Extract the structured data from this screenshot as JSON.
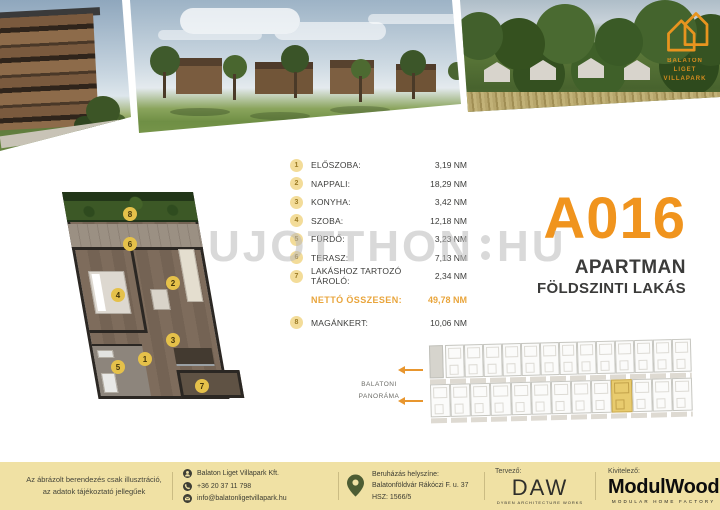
{
  "header": {
    "logo": {
      "line1": "BALATON LIGET",
      "line2": "VILLAPARK"
    }
  },
  "watermark": {
    "left": "UJOTTHON",
    "right": "HU"
  },
  "rooms": {
    "items": [
      {
        "num": "1",
        "label": "ELŐSZOBA:",
        "value": "3,19 NM"
      },
      {
        "num": "2",
        "label": "NAPPALI:",
        "value": "18,29 NM"
      },
      {
        "num": "3",
        "label": "KONYHA:",
        "value": "3,42 NM"
      },
      {
        "num": "4",
        "label": "SZOBA:",
        "value": "12,18 NM"
      },
      {
        "num": "5",
        "label": "FÜRDŐ:",
        "value": "3,23 NM"
      },
      {
        "num": "6",
        "label": "TERASZ:",
        "value": "7,13 NM"
      },
      {
        "num": "7",
        "label": "LAKÁSHOZ TARTOZÓ TÁROLÓ:",
        "value": "2,34 NM"
      }
    ],
    "total": {
      "label": "NETTÓ ÖSSZESEN:",
      "value": "49,78 NM"
    },
    "extra": {
      "num": "8",
      "label": "MAGÁNKERT:",
      "value": "10,06 NM"
    }
  },
  "unit": {
    "code": "A016",
    "type": "APARTMAN",
    "floor": "FÖLDSZINTI LAKÁS"
  },
  "siteplan": {
    "panorama_line1": "BALATONI",
    "panorama_line2": "PANORÁMA"
  },
  "footer": {
    "disclaimer_line1": "Az ábrázolt berendezés csak illusztráció,",
    "disclaimer_line2": "az adatok tájékoztató jellegűek",
    "company": "Balaton Liget Villapark Kft.",
    "phone": "+36 20 37 11 798",
    "email": "info@balatonligetvillapark.hu",
    "location_line1": "Beruházás helyszíne:",
    "location_line2": "Balatonföldvár Rákóczi F. u. 37",
    "location_line3": "HSZ: 1566/5",
    "designer_label": "Tervező:",
    "designer_logo": "DAW",
    "designer_tagline": "DYBEN ARCHITECTURE WORKS",
    "builder_label": "Kivitelező:",
    "builder_logo": "ModulWood",
    "builder_tagline": "MODULAR HOME FACTORY"
  },
  "colors": {
    "accent": "#F0941E",
    "gold": "#E9A53C",
    "footer_bg": "#F0E1A4",
    "highlight": "#E8CB6E"
  }
}
